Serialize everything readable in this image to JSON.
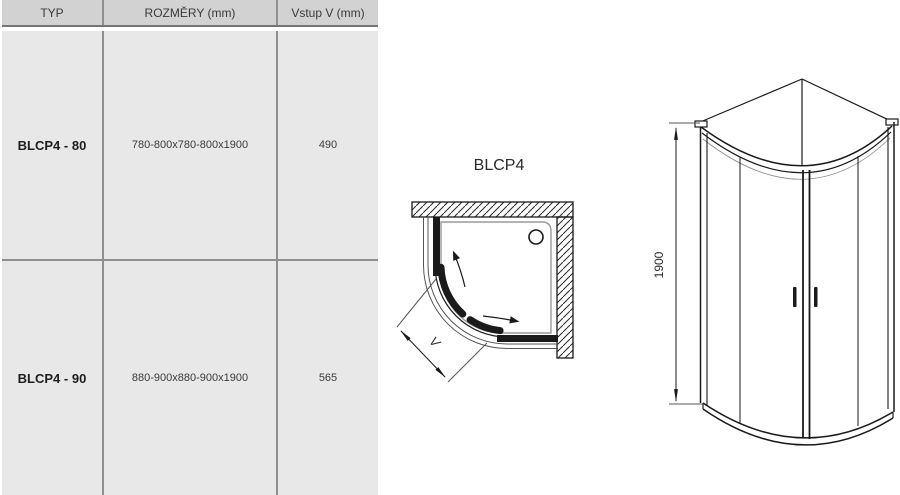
{
  "table": {
    "headers": [
      {
        "label": "TYP"
      },
      {
        "label": "ROZMĚRY (mm)"
      },
      {
        "label": "Vstup V (mm)"
      }
    ],
    "rows": [
      {
        "typ": "BLCP4 - 80",
        "rozmery": "780-800x780-800x1900",
        "vstup": "490"
      },
      {
        "typ": "BLCP4 - 90",
        "rozmery": "880-900x880-900x1900",
        "vstup": "565"
      }
    ]
  },
  "plan_view": {
    "title": "BLCP4",
    "entry_dimension_label": "V"
  },
  "elevation_view": {
    "height_dimension_label": "1900"
  },
  "colors": {
    "header_bg": "#d2d2d2",
    "row_bg": "#e9e8e8",
    "grid_border": "#8f8f8f",
    "header_border": "#757575",
    "drawing_line": "#1a1a1a"
  }
}
